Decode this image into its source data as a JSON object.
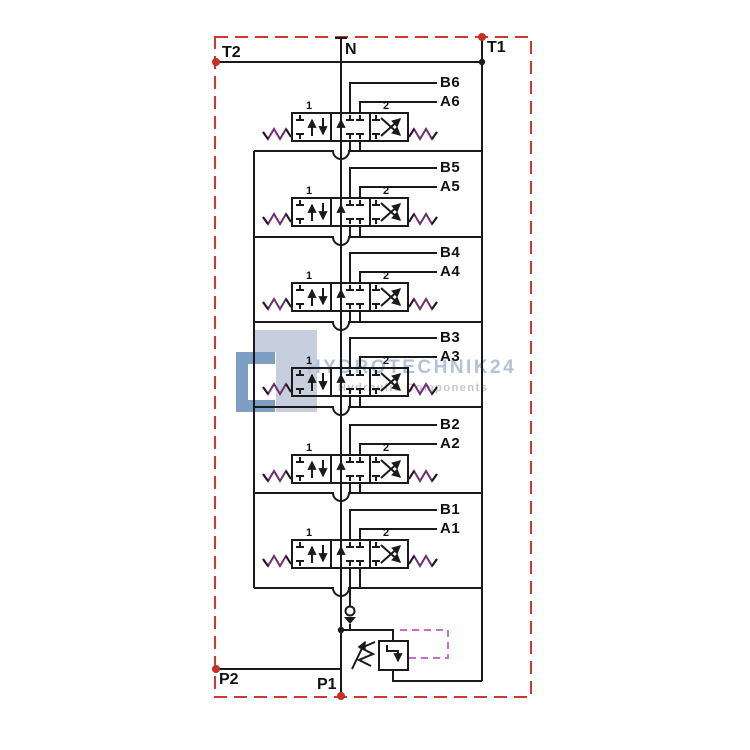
{
  "ports": {
    "t2": "T2",
    "n": "N",
    "t1": "T1",
    "p2": "P2",
    "p1": "P1"
  },
  "sections": [
    {
      "b": "B6",
      "a": "A6"
    },
    {
      "b": "B5",
      "a": "A5"
    },
    {
      "b": "B4",
      "a": "A4"
    },
    {
      "b": "B3",
      "a": "A3"
    },
    {
      "b": "B2",
      "a": "A2"
    },
    {
      "b": "B1",
      "a": "A1"
    }
  ],
  "spool_position_labels": [
    "1",
    "2"
  ],
  "watermark": {
    "title": "HYDROTECHNIK24",
    "subtitle": "Hydraulic Components"
  },
  "colors": {
    "line": "#1a1a1a",
    "border_red": "#cb3a31",
    "port_dot_red": "#c62f28",
    "pilot_magenta": "#c86ec8",
    "spring_purple": "#6e3070",
    "watermark_blue": "#b4c2d7",
    "watermark_gray": "#c6c6c6",
    "logo_blue": "#5e87b5",
    "logo_gray": "#c7cfdf"
  }
}
